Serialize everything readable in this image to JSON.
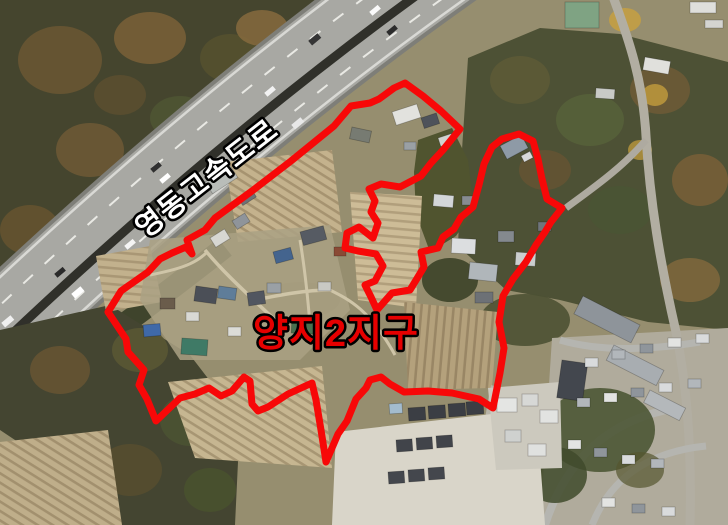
{
  "map": {
    "description": "aerial-photo-with-district-boundary",
    "highway_label": {
      "text": "영동고속도로",
      "fill": "#ffffff",
      "outline": "#000000",
      "outline_width": 5,
      "font_size": 29,
      "x": 213,
      "y": 186,
      "rotation_deg": -38
    },
    "district_label": {
      "text": "양지2지구",
      "fill": "#e60000",
      "outline": "#000000",
      "outline_width": 5,
      "font_size": 38,
      "x": 336,
      "y": 346,
      "rotation_deg": 0
    },
    "boundary": {
      "color": "#f70808",
      "stroke_width": 7,
      "points": [
        [
          405,
          83
        ],
        [
          423,
          96
        ],
        [
          441,
          111
        ],
        [
          460,
          129
        ],
        [
          443,
          150
        ],
        [
          431,
          163
        ],
        [
          421,
          176
        ],
        [
          400,
          187
        ],
        [
          381,
          184
        ],
        [
          369,
          189
        ],
        [
          375,
          201
        ],
        [
          371,
          212
        ],
        [
          378,
          223
        ],
        [
          373,
          238
        ],
        [
          359,
          227
        ],
        [
          347,
          233
        ],
        [
          345,
          248
        ],
        [
          358,
          251
        ],
        [
          376,
          254
        ],
        [
          383,
          266
        ],
        [
          375,
          281
        ],
        [
          365,
          285
        ],
        [
          371,
          297
        ],
        [
          377,
          310
        ],
        [
          392,
          293
        ],
        [
          410,
          290
        ],
        [
          424,
          267
        ],
        [
          421,
          252
        ],
        [
          438,
          248
        ],
        [
          443,
          237
        ],
        [
          454,
          229
        ],
        [
          461,
          217
        ],
        [
          466,
          213
        ],
        [
          473,
          207
        ],
        [
          479,
          185
        ],
        [
          484,
          164
        ],
        [
          492,
          147
        ],
        [
          502,
          139
        ],
        [
          519,
          134
        ],
        [
          533,
          141
        ],
        [
          538,
          159
        ],
        [
          542,
          179
        ],
        [
          547,
          199
        ],
        [
          562,
          208
        ],
        [
          551,
          222
        ],
        [
          545,
          232
        ],
        [
          536,
          245
        ],
        [
          526,
          262
        ],
        [
          513,
          279
        ],
        [
          503,
          296
        ],
        [
          499,
          322
        ],
        [
          504,
          348
        ],
        [
          500,
          373
        ],
        [
          493,
          408
        ],
        [
          479,
          399
        ],
        [
          452,
          393
        ],
        [
          428,
          391
        ],
        [
          404,
          392
        ],
        [
          390,
          384
        ],
        [
          381,
          377
        ],
        [
          370,
          380
        ],
        [
          366,
          388
        ],
        [
          356,
          399
        ],
        [
          347,
          421
        ],
        [
          338,
          434
        ],
        [
          326,
          462
        ],
        [
          321,
          430
        ],
        [
          316,
          400
        ],
        [
          312,
          383
        ],
        [
          288,
          394
        ],
        [
          268,
          407
        ],
        [
          258,
          411
        ],
        [
          252,
          404
        ],
        [
          250,
          381
        ],
        [
          244,
          377
        ],
        [
          232,
          391
        ],
        [
          221,
          396
        ],
        [
          209,
          388
        ],
        [
          195,
          394
        ],
        [
          180,
          398
        ],
        [
          156,
          421
        ],
        [
          147,
          399
        ],
        [
          139,
          385
        ],
        [
          144,
          370
        ],
        [
          128,
          352
        ],
        [
          126,
          339
        ],
        [
          108,
          312
        ],
        [
          121,
          291
        ],
        [
          148,
          272
        ],
        [
          160,
          259
        ],
        [
          172,
          253
        ],
        [
          186,
          247
        ],
        [
          192,
          254
        ],
        [
          187,
          240
        ],
        [
          205,
          230
        ],
        [
          215,
          218
        ],
        [
          252,
          191
        ],
        [
          291,
          161
        ],
        [
          334,
          126
        ],
        [
          351,
          106
        ],
        [
          370,
          103
        ],
        [
          379,
          99
        ],
        [
          394,
          88
        ]
      ]
    }
  }
}
